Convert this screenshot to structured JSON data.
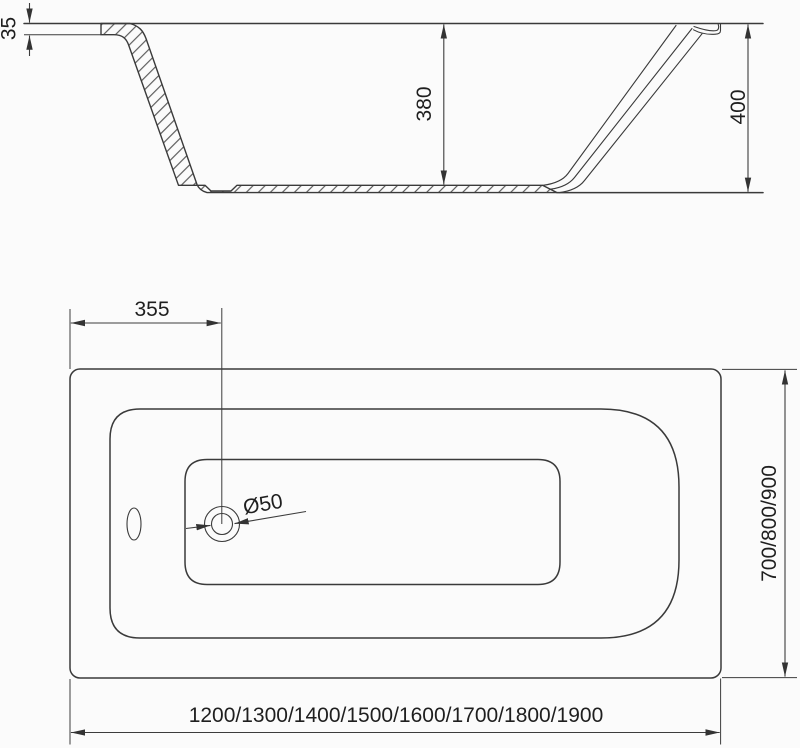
{
  "colors": {
    "line": "#3a3a3a",
    "text": "#1f1f1f",
    "background": "#fbfbfb"
  },
  "side_view": {
    "rim_height": "35",
    "inner_depth": "380",
    "total_height": "400"
  },
  "top_view": {
    "drain_offset": "355",
    "drain_diameter": "Ø50",
    "width_options": "700/800/900",
    "length_options": "1200/1300/1400/1500/1600/1700/1800/1900"
  }
}
